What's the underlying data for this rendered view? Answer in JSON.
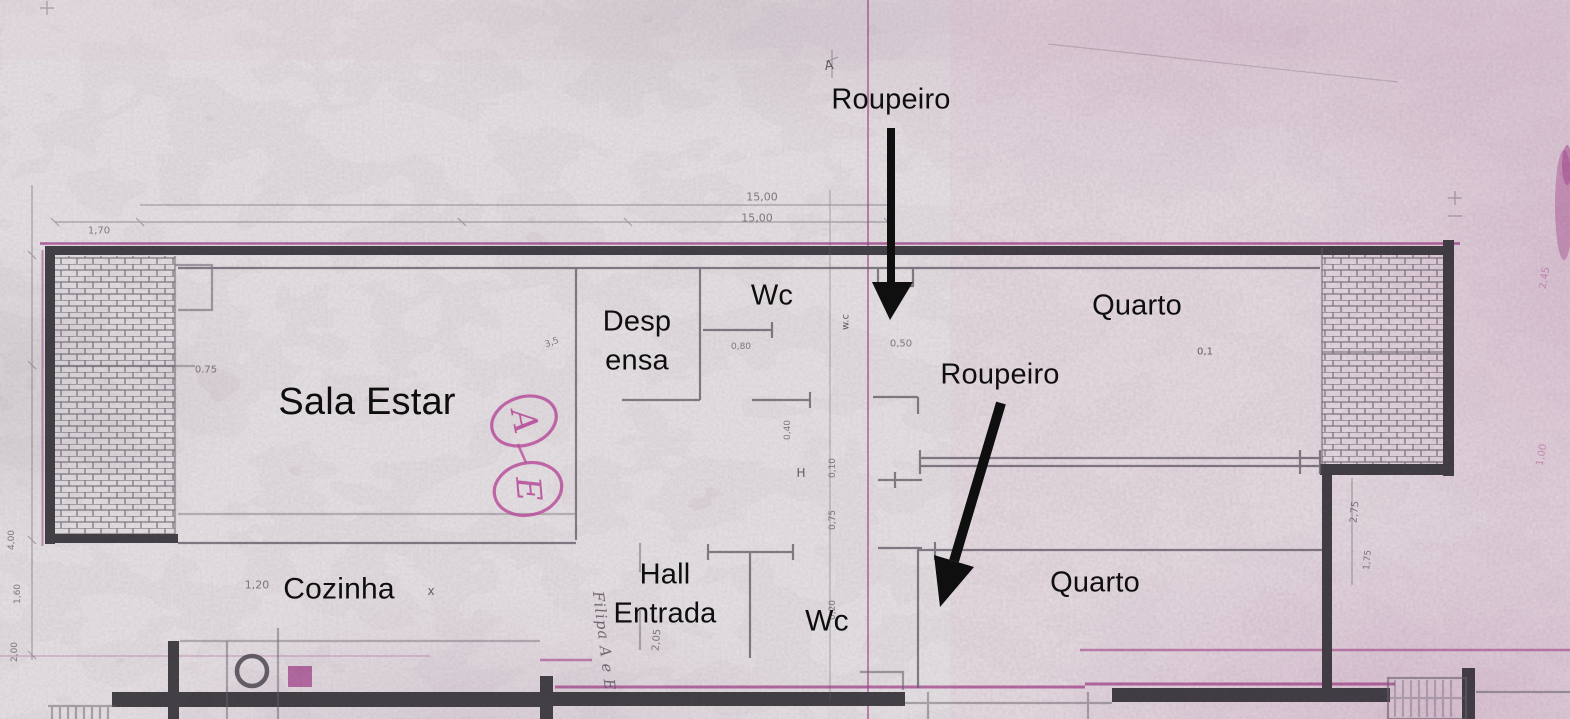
{
  "meta": {
    "title": "Planta de piso digitalizada (scanned apartment floor plan)"
  },
  "colors": {
    "paper": "#ebe6e8",
    "ink_black": "#0f0f0f",
    "pencil_gray": "#6b6670",
    "wall_dark": "#454248",
    "magenta_line": "#a8468f",
    "pink_handwriting": "#c355a4"
  },
  "room_labels": [
    {
      "id": "roupeiro-top",
      "text": "Roupeiro",
      "x": 891,
      "y": 100,
      "size": 29
    },
    {
      "id": "wc-top",
      "text": "Wc",
      "x": 772,
      "y": 296,
      "size": 29
    },
    {
      "id": "despensa",
      "lines": [
        "Desp",
        "ensa"
      ],
      "x": 637,
      "y": 342,
      "size": 29
    },
    {
      "id": "quarto-top",
      "text": "Quarto",
      "x": 1137,
      "y": 306,
      "size": 29
    },
    {
      "id": "sala-estar",
      "text": "Sala Estar",
      "x": 367,
      "y": 403,
      "size": 38
    },
    {
      "id": "roupeiro-mid",
      "text": "Roupeiro",
      "x": 1000,
      "y": 375,
      "size": 29
    },
    {
      "id": "cozinha",
      "text": "Cozinha",
      "x": 339,
      "y": 590,
      "size": 30
    },
    {
      "id": "hall-entrada",
      "lines": [
        "Hall",
        "Entrada"
      ],
      "x": 665,
      "y": 595,
      "size": 29
    },
    {
      "id": "wc-bottom",
      "text": "Wc",
      "x": 827,
      "y": 622,
      "size": 30
    },
    {
      "id": "quarto-bottom",
      "text": "Quarto",
      "x": 1095,
      "y": 583,
      "size": 29
    }
  ],
  "arrows": [
    {
      "id": "arrow-roupeiro-top",
      "x1": 891,
      "y1": 128,
      "x2": 891,
      "y2": 288,
      "width": 8,
      "head": "890,320 872,282 913,282"
    },
    {
      "id": "arrow-roupeiro-mid",
      "x1": 1001,
      "y1": 403,
      "x2": 954,
      "y2": 561,
      "width": 10,
      "head": "940,607 974,567 934,555"
    }
  ],
  "handwriting": {
    "circled_letters": [
      {
        "letter": "A",
        "cx": 524,
        "cy": 421,
        "rx": 33,
        "ry": 24,
        "rot": -18,
        "text_rot": 97,
        "size": 34
      },
      {
        "letter": "E",
        "cx": 528,
        "cy": 489,
        "rx": 34,
        "ry": 26,
        "rot": -12,
        "text_rot": 97,
        "size": 34
      }
    ],
    "note": {
      "text": "Filipa A e E",
      "x": 604,
      "y": 641,
      "rot": 83,
      "size": 15
    }
  },
  "dimension_texts": [
    {
      "text": "15,00",
      "x": 762,
      "y": 197,
      "rot": 0,
      "size": 11
    },
    {
      "text": "15,00",
      "x": 757,
      "y": 218,
      "rot": 0,
      "size": 11
    },
    {
      "text": "1,70",
      "x": 99,
      "y": 231,
      "rot": 0,
      "size": 10
    },
    {
      "text": "0,50",
      "x": 901,
      "y": 344,
      "rot": 0,
      "size": 10
    },
    {
      "text": "0,80",
      "x": 741,
      "y": 347,
      "rot": 0,
      "size": 9
    },
    {
      "text": "0.75",
      "x": 206,
      "y": 370,
      "rot": 0,
      "size": 10
    },
    {
      "text": "3,5",
      "x": 552,
      "y": 343,
      "rot": -20,
      "size": 9
    },
    {
      "text": "1,20",
      "x": 257,
      "y": 585,
      "rot": 0,
      "size": 11
    },
    {
      "text": "0,10",
      "x": 833,
      "y": 468,
      "rot": -90,
      "size": 9
    },
    {
      "text": "0,75",
      "x": 833,
      "y": 520,
      "rot": -90,
      "size": 9
    },
    {
      "text": "0,20",
      "x": 833,
      "y": 610,
      "rot": -90,
      "size": 9
    },
    {
      "text": "0,40",
      "x": 788,
      "y": 430,
      "rot": -90,
      "size": 9
    },
    {
      "text": "2,05",
      "x": 657,
      "y": 640,
      "rot": -85,
      "size": 10
    },
    {
      "text": "2,75",
      "x": 1355,
      "y": 512,
      "rot": -85,
      "size": 10
    },
    {
      "text": "1,75",
      "x": 1368,
      "y": 560,
      "rot": -85,
      "size": 9
    },
    {
      "text": "2,45",
      "x": 1545,
      "y": 278,
      "rot": -80,
      "size": 10,
      "tone": "pink"
    },
    {
      "text": "1,00",
      "x": 1542,
      "y": 455,
      "rot": -80,
      "size": 10,
      "tone": "pink"
    },
    {
      "text": "1,60",
      "x": 18,
      "y": 594,
      "rot": -90,
      "size": 9
    },
    {
      "text": "2,00",
      "x": 15,
      "y": 652,
      "rot": -90,
      "size": 9
    },
    {
      "text": "4,00",
      "x": 12,
      "y": 540,
      "rot": -90,
      "size": 9
    }
  ],
  "small_marks": [
    {
      "text": "A",
      "x": 829,
      "y": 66,
      "rot": -8,
      "size": 13
    },
    {
      "text": "H",
      "x": 801,
      "y": 473,
      "rot": 0,
      "size": 12
    },
    {
      "text": "x",
      "x": 431,
      "y": 591,
      "rot": 0,
      "size": 12
    },
    {
      "text": "w.c",
      "x": 846,
      "y": 322,
      "rot": -90,
      "size": 10
    },
    {
      "text": "0,1",
      "x": 1205,
      "y": 352,
      "rot": 0,
      "size": 10
    }
  ]
}
